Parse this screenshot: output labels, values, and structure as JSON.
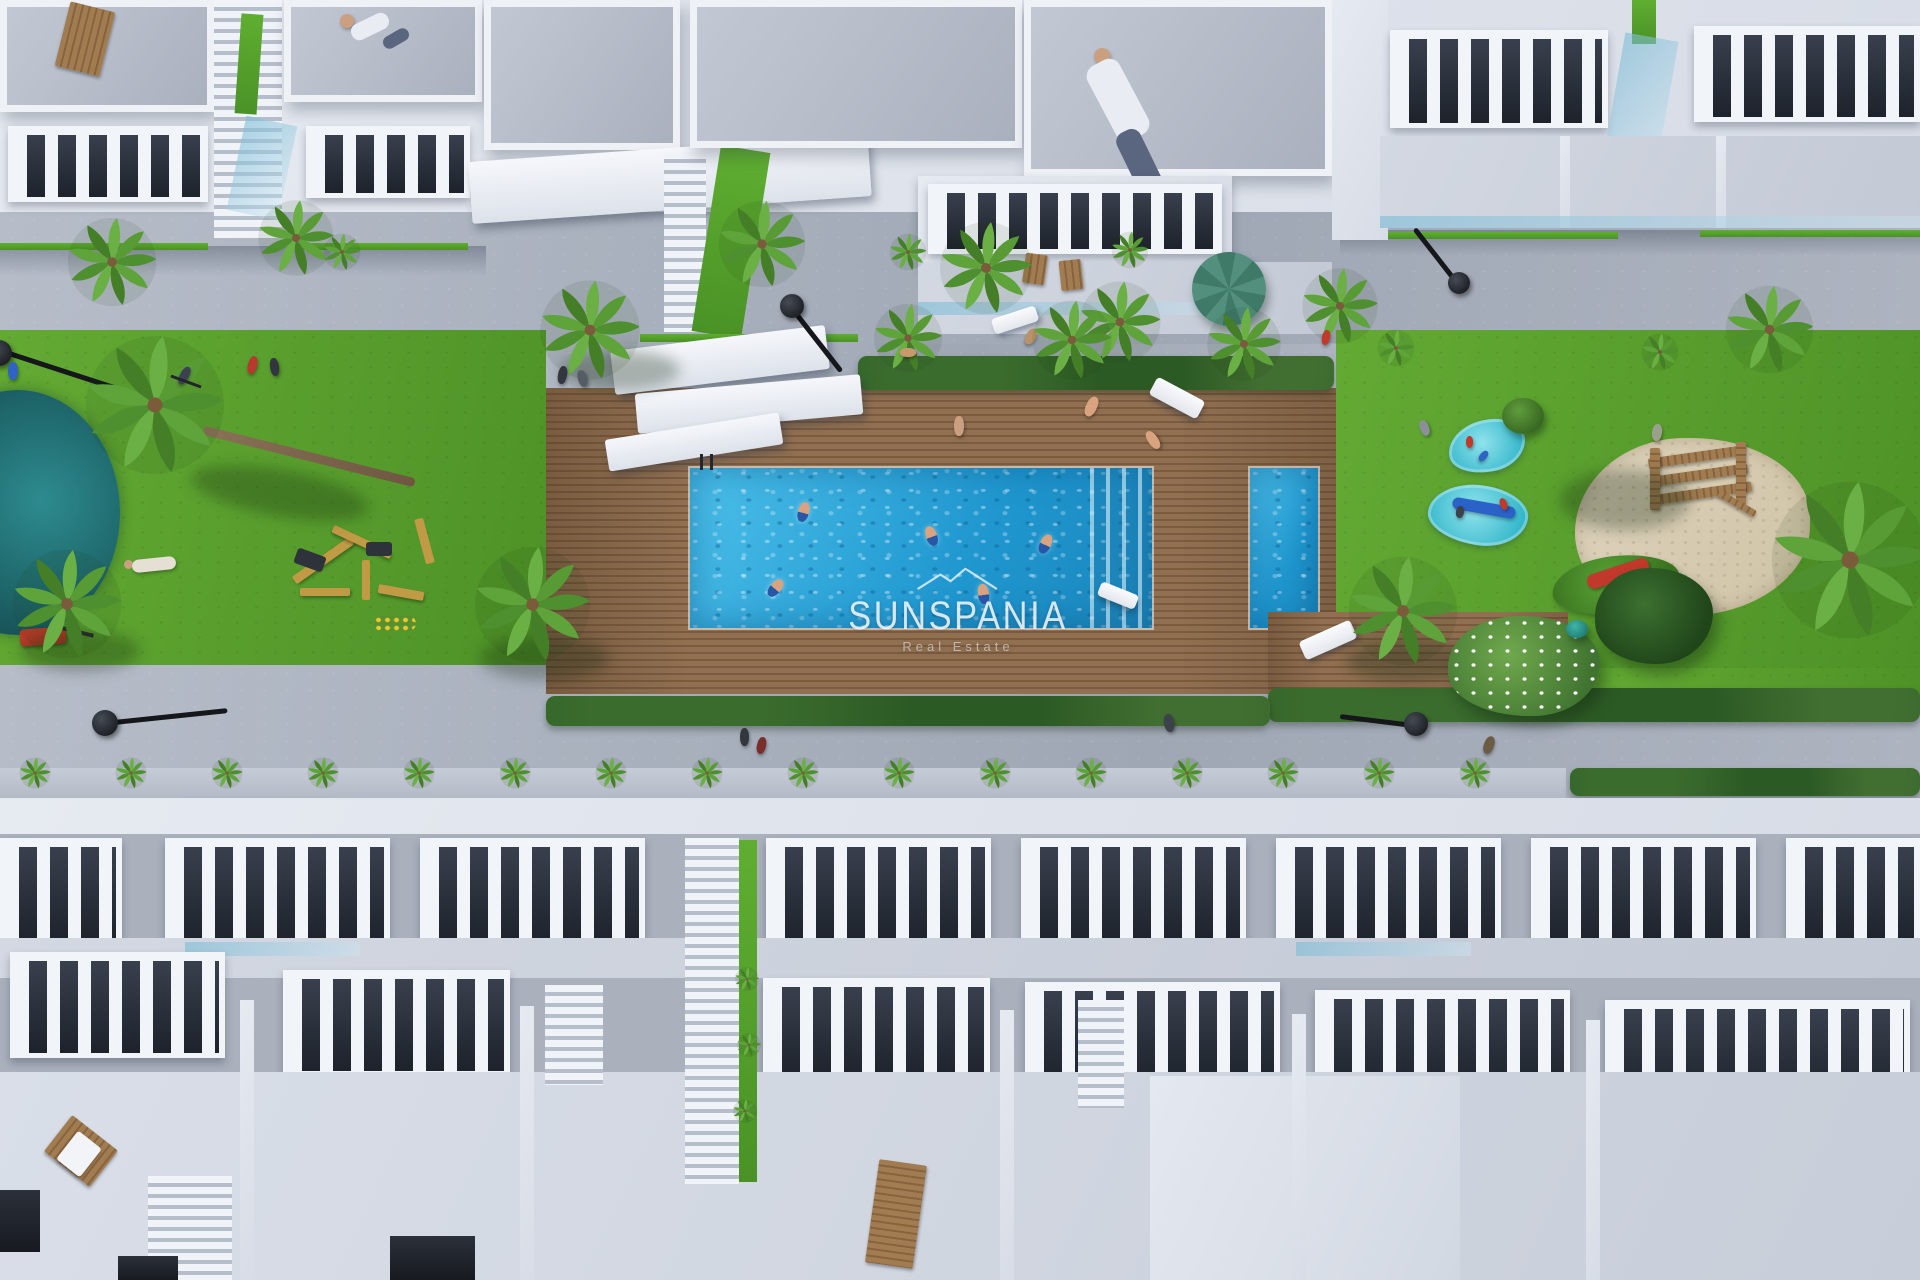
{
  "image": {
    "type": "aerial-3d-render",
    "description": "Top-down 3D architectural rendering of a residential complex: rows of white townhouses with balustraded roof terraces around a central landscaped courtyard with a communal swimming pool, wooden sun deck, lawns, splash pads, sand playground and palm trees",
    "watermark": {
      "brand": "SUNSPANIA",
      "tagline": "Real Estate",
      "logo": "mountain-outline-icon",
      "color": "#ffffff"
    }
  },
  "palette": {
    "path": "#9fa7b4",
    "path-light": "#b6bdc9",
    "roof": "#a9b0bd",
    "roof-light": "#c3c9d4",
    "white": "#f1f4f8",
    "lawn": "#4e9227",
    "lawn-light": "#63aa33",
    "grass-bright": "#5fae31",
    "deck": "#917051",
    "deck-line": "#7a5b40",
    "pool": "#1f97cf",
    "pool-light": "#4cc0ea",
    "splash": "#2fb4c8",
    "hedge": "#2f5f27",
    "sand": "#cfc3a6",
    "wood": "#a07c50"
  },
  "scene": {
    "features": [
      "communal-pool",
      "children-pool",
      "pool-steps",
      "wooden-sun-deck",
      "lawn-gardens",
      "splash-pads",
      "sand-playground",
      "outdoor-gym",
      "palm-trees",
      "street-lamps",
      "roof-terraces",
      "balcony-railings",
      "sunbathers",
      "swimmers",
      "pedestrians"
    ]
  }
}
